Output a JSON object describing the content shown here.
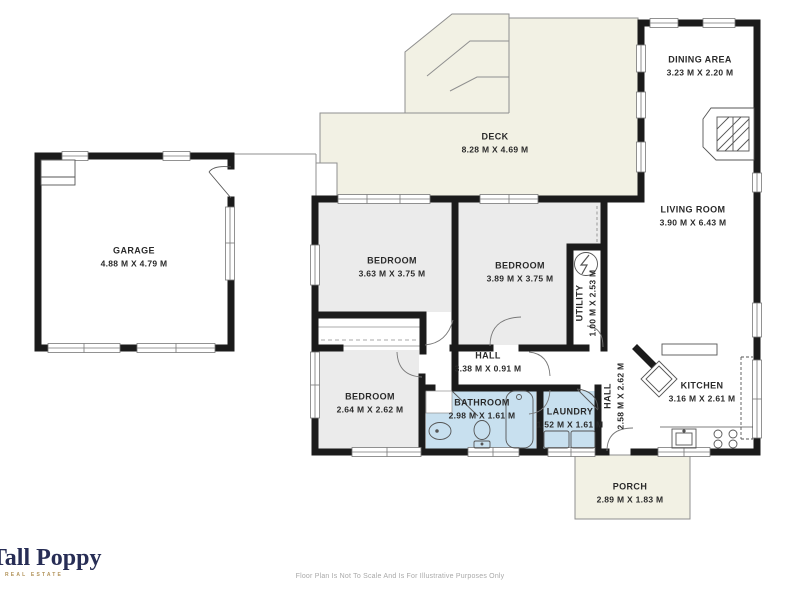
{
  "rooms": {
    "garage": {
      "name": "GARAGE",
      "dims": "4.88 M X 4.79 M"
    },
    "deck": {
      "name": "DECK",
      "dims": "8.28 M X 4.69 M"
    },
    "dining": {
      "name": "DINING AREA",
      "dims": "3.23 M X 2.20 M"
    },
    "living": {
      "name": "LIVING ROOM",
      "dims": "3.90 M X 6.43 M"
    },
    "bedroom1": {
      "name": "BEDROOM",
      "dims": "3.63 M X 3.75 M"
    },
    "bedroom2": {
      "name": "BEDROOM",
      "dims": "3.89 M X 3.75 M"
    },
    "bedroom3": {
      "name": "BEDROOM",
      "dims": "2.64 M X 2.62 M"
    },
    "utility": {
      "name": "UTILITY",
      "dims": "1.00 M X 2.53 M"
    },
    "hall": {
      "name": "HALL",
      "dims": "3.38 M X 0.91 M"
    },
    "hall2": {
      "name": "HALL",
      "dims": "2.58 M X 2.62 M"
    },
    "bathroom": {
      "name": "BATHROOM",
      "dims": "2.98 M X 1.61 M"
    },
    "laundry": {
      "name": "LAUNDRY",
      "dims": "1.52 M X 1.61 M"
    },
    "kitchen": {
      "name": "KITCHEN",
      "dims": "3.16 M X 2.61 M"
    },
    "porch": {
      "name": "PORCH",
      "dims": "2.89 M X 1.83 M"
    }
  },
  "branding": {
    "logo": "Tall Poppy",
    "tagline": "REAL ESTATE"
  },
  "footer": {
    "disclaimer": "Floor Plan Is Not To Scale And Is For Illustrative Purposes Only"
  },
  "colors": {
    "wall": "#1b1b1b",
    "bedroom": "#ebebeb",
    "wet": "#c8e0ef",
    "outdoor": "#f2f1e4",
    "line": "#8f8f8f",
    "fixture": "#555555",
    "label": "#2a2a2a",
    "logo_navy": "#272d55",
    "logo_gold": "#b2935a",
    "footer_gray": "#a9a9a9"
  }
}
